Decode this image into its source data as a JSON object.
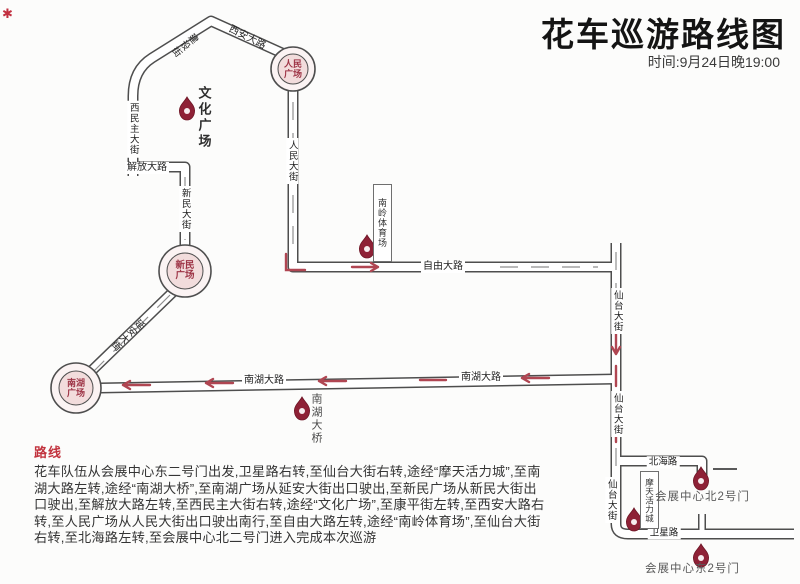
{
  "header": {
    "title": "花车巡游路线图",
    "subtitle": "时间:9月24日晚19:00"
  },
  "map": {
    "corner_mark": "✱",
    "plazas": {
      "renmin": {
        "line1": "人民",
        "line2": "广场"
      },
      "xinmin": {
        "line1": "新民",
        "line2": "广场"
      },
      "nanhu": {
        "line1": "南湖",
        "line2": "广场"
      }
    },
    "roads": {
      "jianshe_jie": "建设街",
      "xian_dalu": "西安大路",
      "ximinzhu_dajie": "西民主大街",
      "jiefang_dalu": "解放大路",
      "xinmin_dajie": "新民大街",
      "renmin_dajie": "人民大街",
      "ziyou_dalu": "自由大路",
      "xiantai_dajie": "仙台大街",
      "nanhu_dalu": "南湖大路",
      "yanan_dajie": "延安大街",
      "beihai_lu": "北海路",
      "weixing_lu": "卫星路"
    },
    "landmarks": {
      "wenhua_guangchang": "文化广场",
      "nanling_stadium": "南岭体育场",
      "nanhu_bridge": "南湖大桥",
      "motian_city": "摩天活力城",
      "north_gate2": "会展中心北2号门",
      "east_gate2": "会展中心东2号门"
    }
  },
  "route": {
    "heading": "路线",
    "lines": [
      "花车队伍从会展中心东二号门出发,卫星路右转,至仙台大街右转,途经“摩天活力城”,至南",
      "湖大路左转,途经“南湖大桥”,至南湖广场从延安大街出口驶出,至新民广场从新民大街出",
      "口驶出,至解放大路左转,至西民主大街右转,途经“文化广场”,至康平街左转,至西安大路右",
      "转,至人民广场从人民大街出口驶出南行,至自由大路左转,途经“南岭体育场”,至仙台大街",
      "右转,至北海路左转,至会展中心北二号门进入完成本次巡游"
    ]
  }
}
